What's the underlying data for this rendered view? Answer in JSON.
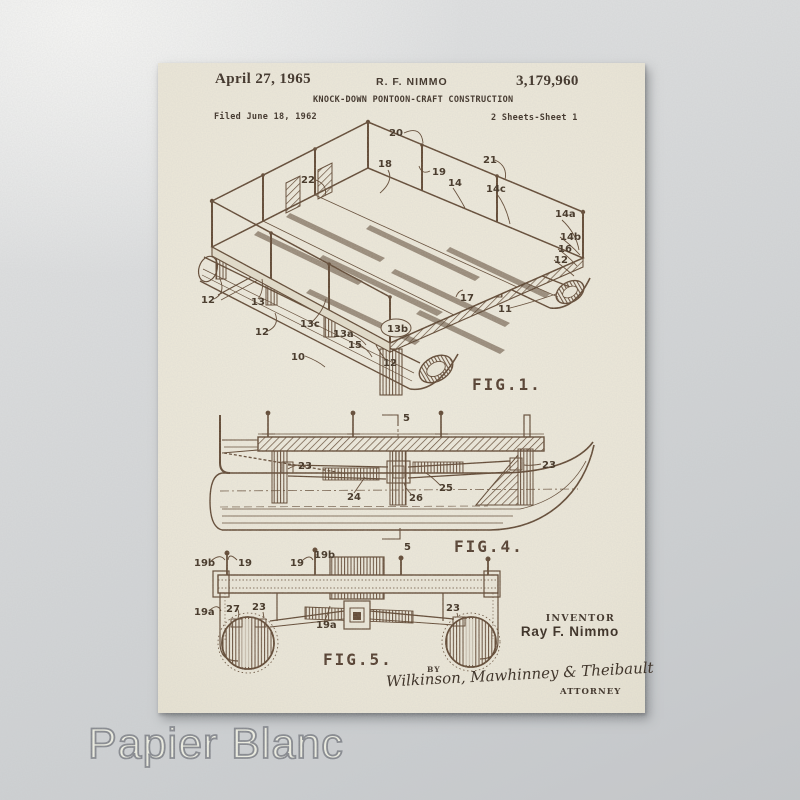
{
  "watermark": "Papier Blanc",
  "patent": {
    "date": "April 27, 1965",
    "applicant": "R. F. NIMMO",
    "number": "3,179,960",
    "title": "KNOCK-DOWN PONTOON-CRAFT CONSTRUCTION",
    "filed": "Filed June 18, 1962",
    "sheet": "2 Sheets-Sheet 1"
  },
  "figures": {
    "fig1": {
      "caption": "FIG.1.",
      "labels": [
        "20",
        "22",
        "18",
        "19",
        "21",
        "14",
        "14c",
        "14a",
        "14b",
        "16",
        "12",
        "11",
        "17",
        "12",
        "13",
        "12",
        "13c",
        "13a",
        "15",
        "13b",
        "10",
        "12"
      ]
    },
    "fig4": {
      "caption": "FIG.4.",
      "labels": [
        "5",
        "23",
        "23",
        "24",
        "25",
        "26",
        "5"
      ]
    },
    "fig5": {
      "caption": "FIG.5.",
      "labels": [
        "19b",
        "19",
        "19",
        "19b",
        "19a",
        "27",
        "23",
        "19a",
        "23"
      ]
    }
  },
  "signature_block": {
    "inventor_label": "INVENTOR",
    "inventor_name": "Ray F. Nimmo",
    "by_label": "BY",
    "signature": "Wilkinson, Mawhinney & Theibault",
    "attorney_label": "ATTORNEY"
  },
  "colors": {
    "paper": "#ece7d7",
    "ink": "#5a3f28",
    "label_ink": "#382817",
    "background": "#d2d5d7",
    "watermark_fill": "#eff0e3",
    "watermark_stroke": "#81848a"
  }
}
